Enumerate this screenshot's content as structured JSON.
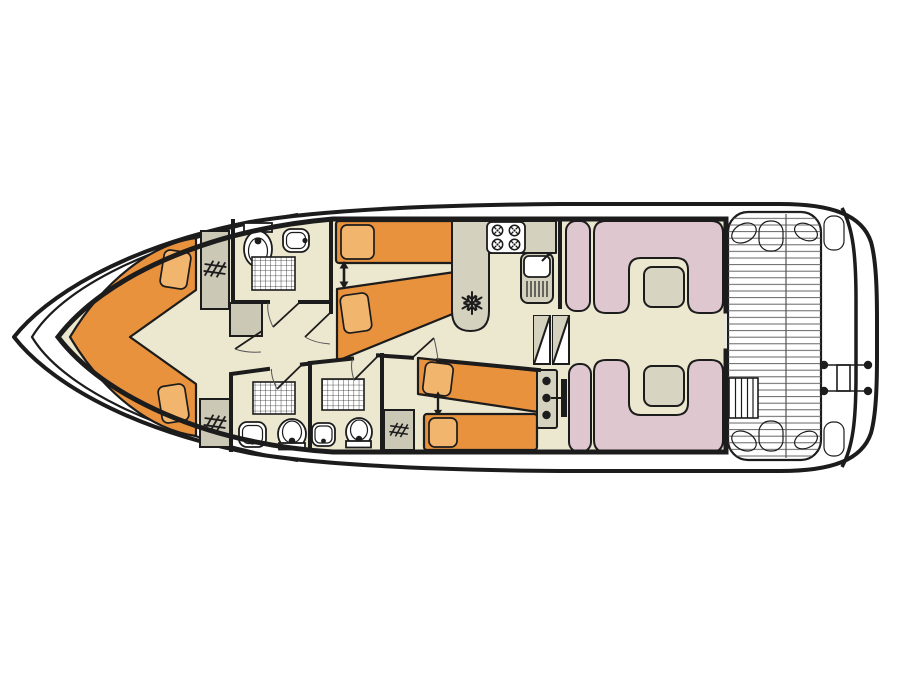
{
  "title": "Houseboat deck floor plan",
  "colors": {
    "hull": "#1c1c1c",
    "floor": "#ece7cf",
    "bed": "#e8923e",
    "pillow": "#f2b56d",
    "counter": "#d4d1bf",
    "seat": "#dfc7d0",
    "table": "#d7d4c2",
    "wardrobe": "#cbc8b6",
    "deckline": "#555555"
  },
  "plan": {
    "bow_cabin": {
      "name": "bow cabin",
      "bed": "v-shaped double berth",
      "pillows": 2,
      "wardrobes": 2,
      "icons": [
        "double-v-berth-icon",
        "wardrobe-hanger-icon"
      ]
    },
    "forward_bathroom": {
      "name": "forward bathroom",
      "fixtures": [
        "toilet",
        "washbasin",
        "shower"
      ],
      "icons": [
        "toilet-icon",
        "washbasin-icon",
        "shower-grid-icon"
      ]
    },
    "port_twin_cabin": {
      "name": "port twin cabin",
      "beds": 2,
      "pillows": 2,
      "joinable_beds_arrow": true,
      "icons": [
        "single-bed-icon",
        "joinable-beds-arrow-icon"
      ]
    },
    "aft_twin_cabin": {
      "name": "starboard aft twin cabin",
      "beds": 2,
      "pillows": 2,
      "joinable_beds_arrow": true,
      "wardrobe": true,
      "icons": [
        "single-bed-icon",
        "joinable-beds-arrow-icon",
        "wardrobe-hanger-icon"
      ]
    },
    "aft_bathroom_1": {
      "name": "aft bathroom 1",
      "fixtures": [
        "shower",
        "washbasin",
        "toilet"
      ],
      "icons": [
        "shower-grid-icon",
        "washbasin-icon",
        "toilet-icon"
      ]
    },
    "aft_bathroom_2": {
      "name": "aft bathroom 2",
      "fixtures": [
        "shower",
        "washbasin",
        "toilet"
      ],
      "icons": [
        "shower-grid-icon",
        "washbasin-icon",
        "toilet-icon"
      ]
    },
    "galley": {
      "name": "galley kitchen",
      "fixtures": [
        "four-burner-hob",
        "sink-with-drainer",
        "refrigerator"
      ],
      "icons": [
        "hob-burner-icon",
        "sink-icon",
        "snowflake-fridge-icon"
      ]
    },
    "saloon": {
      "name": "saloon",
      "sofas": 2,
      "tables": 2,
      "side_benches": 2,
      "icons": [
        "u-sofa-icon",
        "table-icon"
      ]
    },
    "helm": {
      "name": "inside steering position",
      "icons": [
        "helm-console-icon",
        "steps-icon"
      ]
    },
    "aft_deck": {
      "name": "aft deck",
      "features": [
        "plank decking",
        "corner seats",
        "deck steps",
        "stern boarding ladder"
      ],
      "icons": [
        "deck-planks-icon",
        "boarding-ladder-icon"
      ]
    }
  }
}
